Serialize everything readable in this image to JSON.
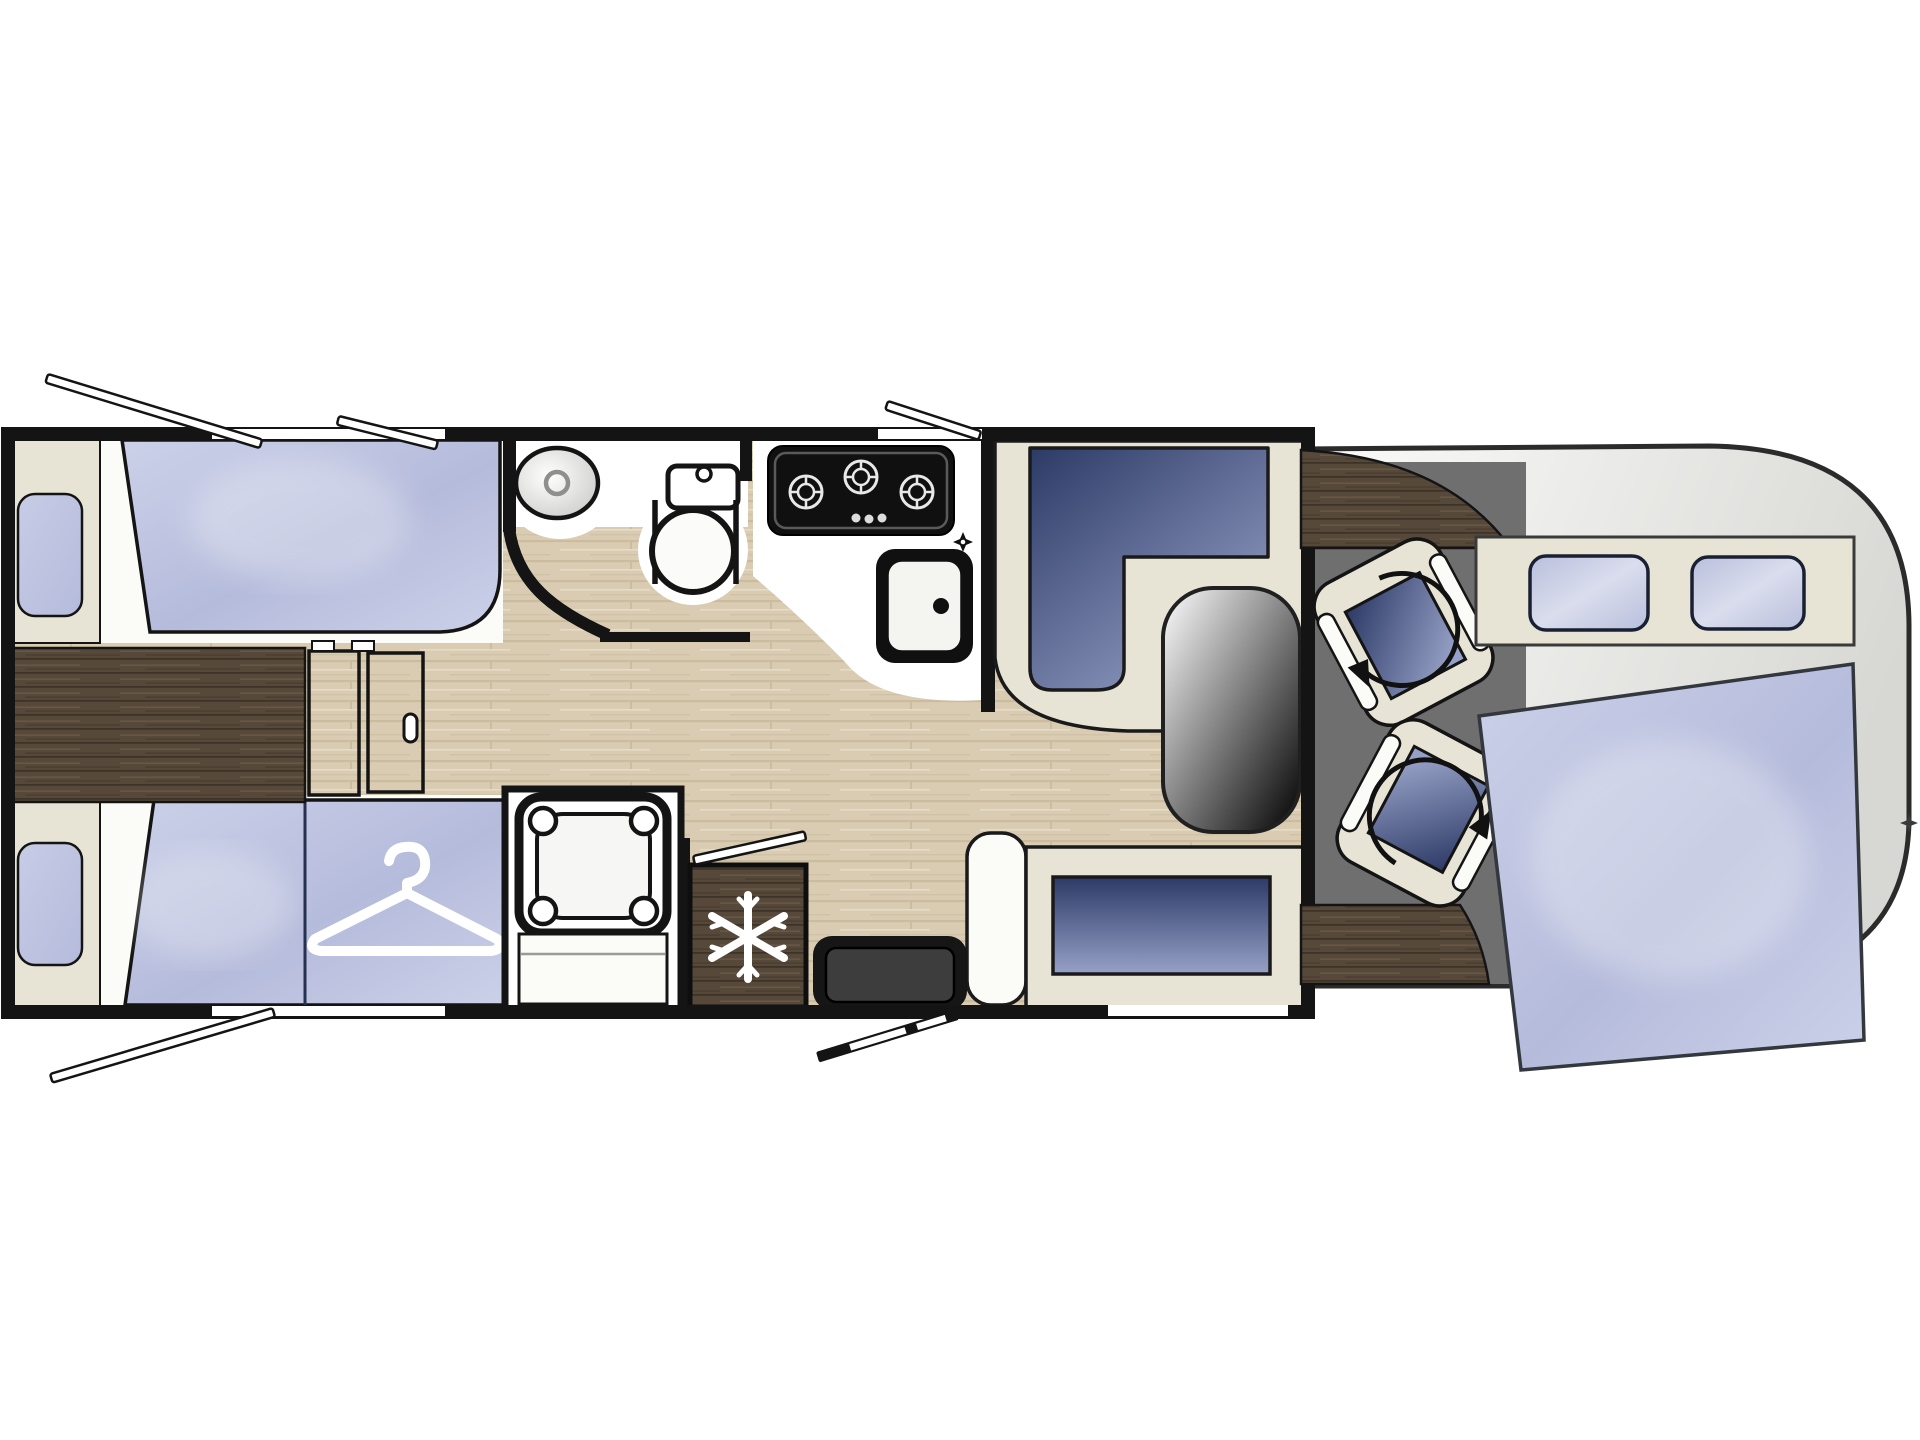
{
  "diagram": {
    "kind": "motorhome-floorplan",
    "description": "Top-down RV layout: rear twin single beds with wardrobe, central sliding door, washroom with round basin and toilet, separate shower cubicle, kitchen with 3-burner hob and sink, fridge-freezer, entrance door with step, L-shaped dinette lounge with oval pedestal table, two swivel cab seats with rotation arrows, drop-down over-cab double bed, open-window indicators on the walls"
  },
  "palette": {
    "white": "#ffffff",
    "deck_white": "#fbfbf8",
    "cream": "#e7e4d6",
    "cream_dark": "#dedacb",
    "outline": "#141414",
    "fixture_black": "#101010",
    "step_gray": "#3d3d3d",
    "mattress_light": "#ccd1e9",
    "mattress_mid": "#b5bbdb",
    "mattress_dark": "#a6acd0",
    "pillow_light": "#c7cce6",
    "navy_dark": "#2c3a66",
    "navy_light": "#97a1c7",
    "window_blue": "#b9bfdd",
    "window_blue_light": "#dadded",
    "wood_dark": "#57493a",
    "wood_dark_streak": "#382f24",
    "wood_dark_hilite": "#6f5f4b",
    "wood_light": "#d9ccb2",
    "wood_light_streak": "#bfae90",
    "wood_light_hilite": "#e9e0cd",
    "cab_floor_gray": "#6f6f6f",
    "body_gray": "#d7d7d3",
    "body_white": "#fbfbfa",
    "basin_gray": "#c9c9c6",
    "table_white": "#ffffff"
  },
  "areas": {
    "rear_bedroom": {
      "name": "rear-twin-beds",
      "fixtures": [
        "single-bed-top",
        "single-bed-bottom",
        "wardrobe-under-bed",
        "center-chest",
        "sliding-door",
        "pillow-top",
        "pillow-bottom",
        "hanger-icon"
      ]
    },
    "washroom": {
      "name": "washroom",
      "fixtures": [
        "round-basin",
        "cassette-toilet",
        "curved-partition-wall"
      ]
    },
    "shower": {
      "name": "shower-cubicle",
      "fixtures": [
        "shower-tray",
        "shower-bench",
        "shower-door-swing"
      ]
    },
    "kitchen": {
      "name": "kitchen",
      "fixtures": [
        "three-burner-hob",
        "kitchen-sink",
        "tap",
        "fridge-freezer",
        "snowflake-icon"
      ]
    },
    "lounge": {
      "name": "dinette-lounge",
      "fixtures": [
        "l-shaped-seat",
        "oval-pedestal-table",
        "side-bench",
        "entrance-step",
        "entry-door-swing"
      ]
    },
    "cab": {
      "name": "driver-cab",
      "fixtures": [
        "driver-swivel-seat",
        "passenger-swivel-seat",
        "rotation-arrow",
        "dashboard-console",
        "drop-down-bed",
        "headboard-panel",
        "headboard-window-1",
        "headboard-window-2"
      ]
    },
    "markers": [
      "open-window-indicator-1",
      "open-window-indicator-2",
      "open-window-indicator-3",
      "open-window-indicator-4",
      "mirror-mark"
    ]
  }
}
